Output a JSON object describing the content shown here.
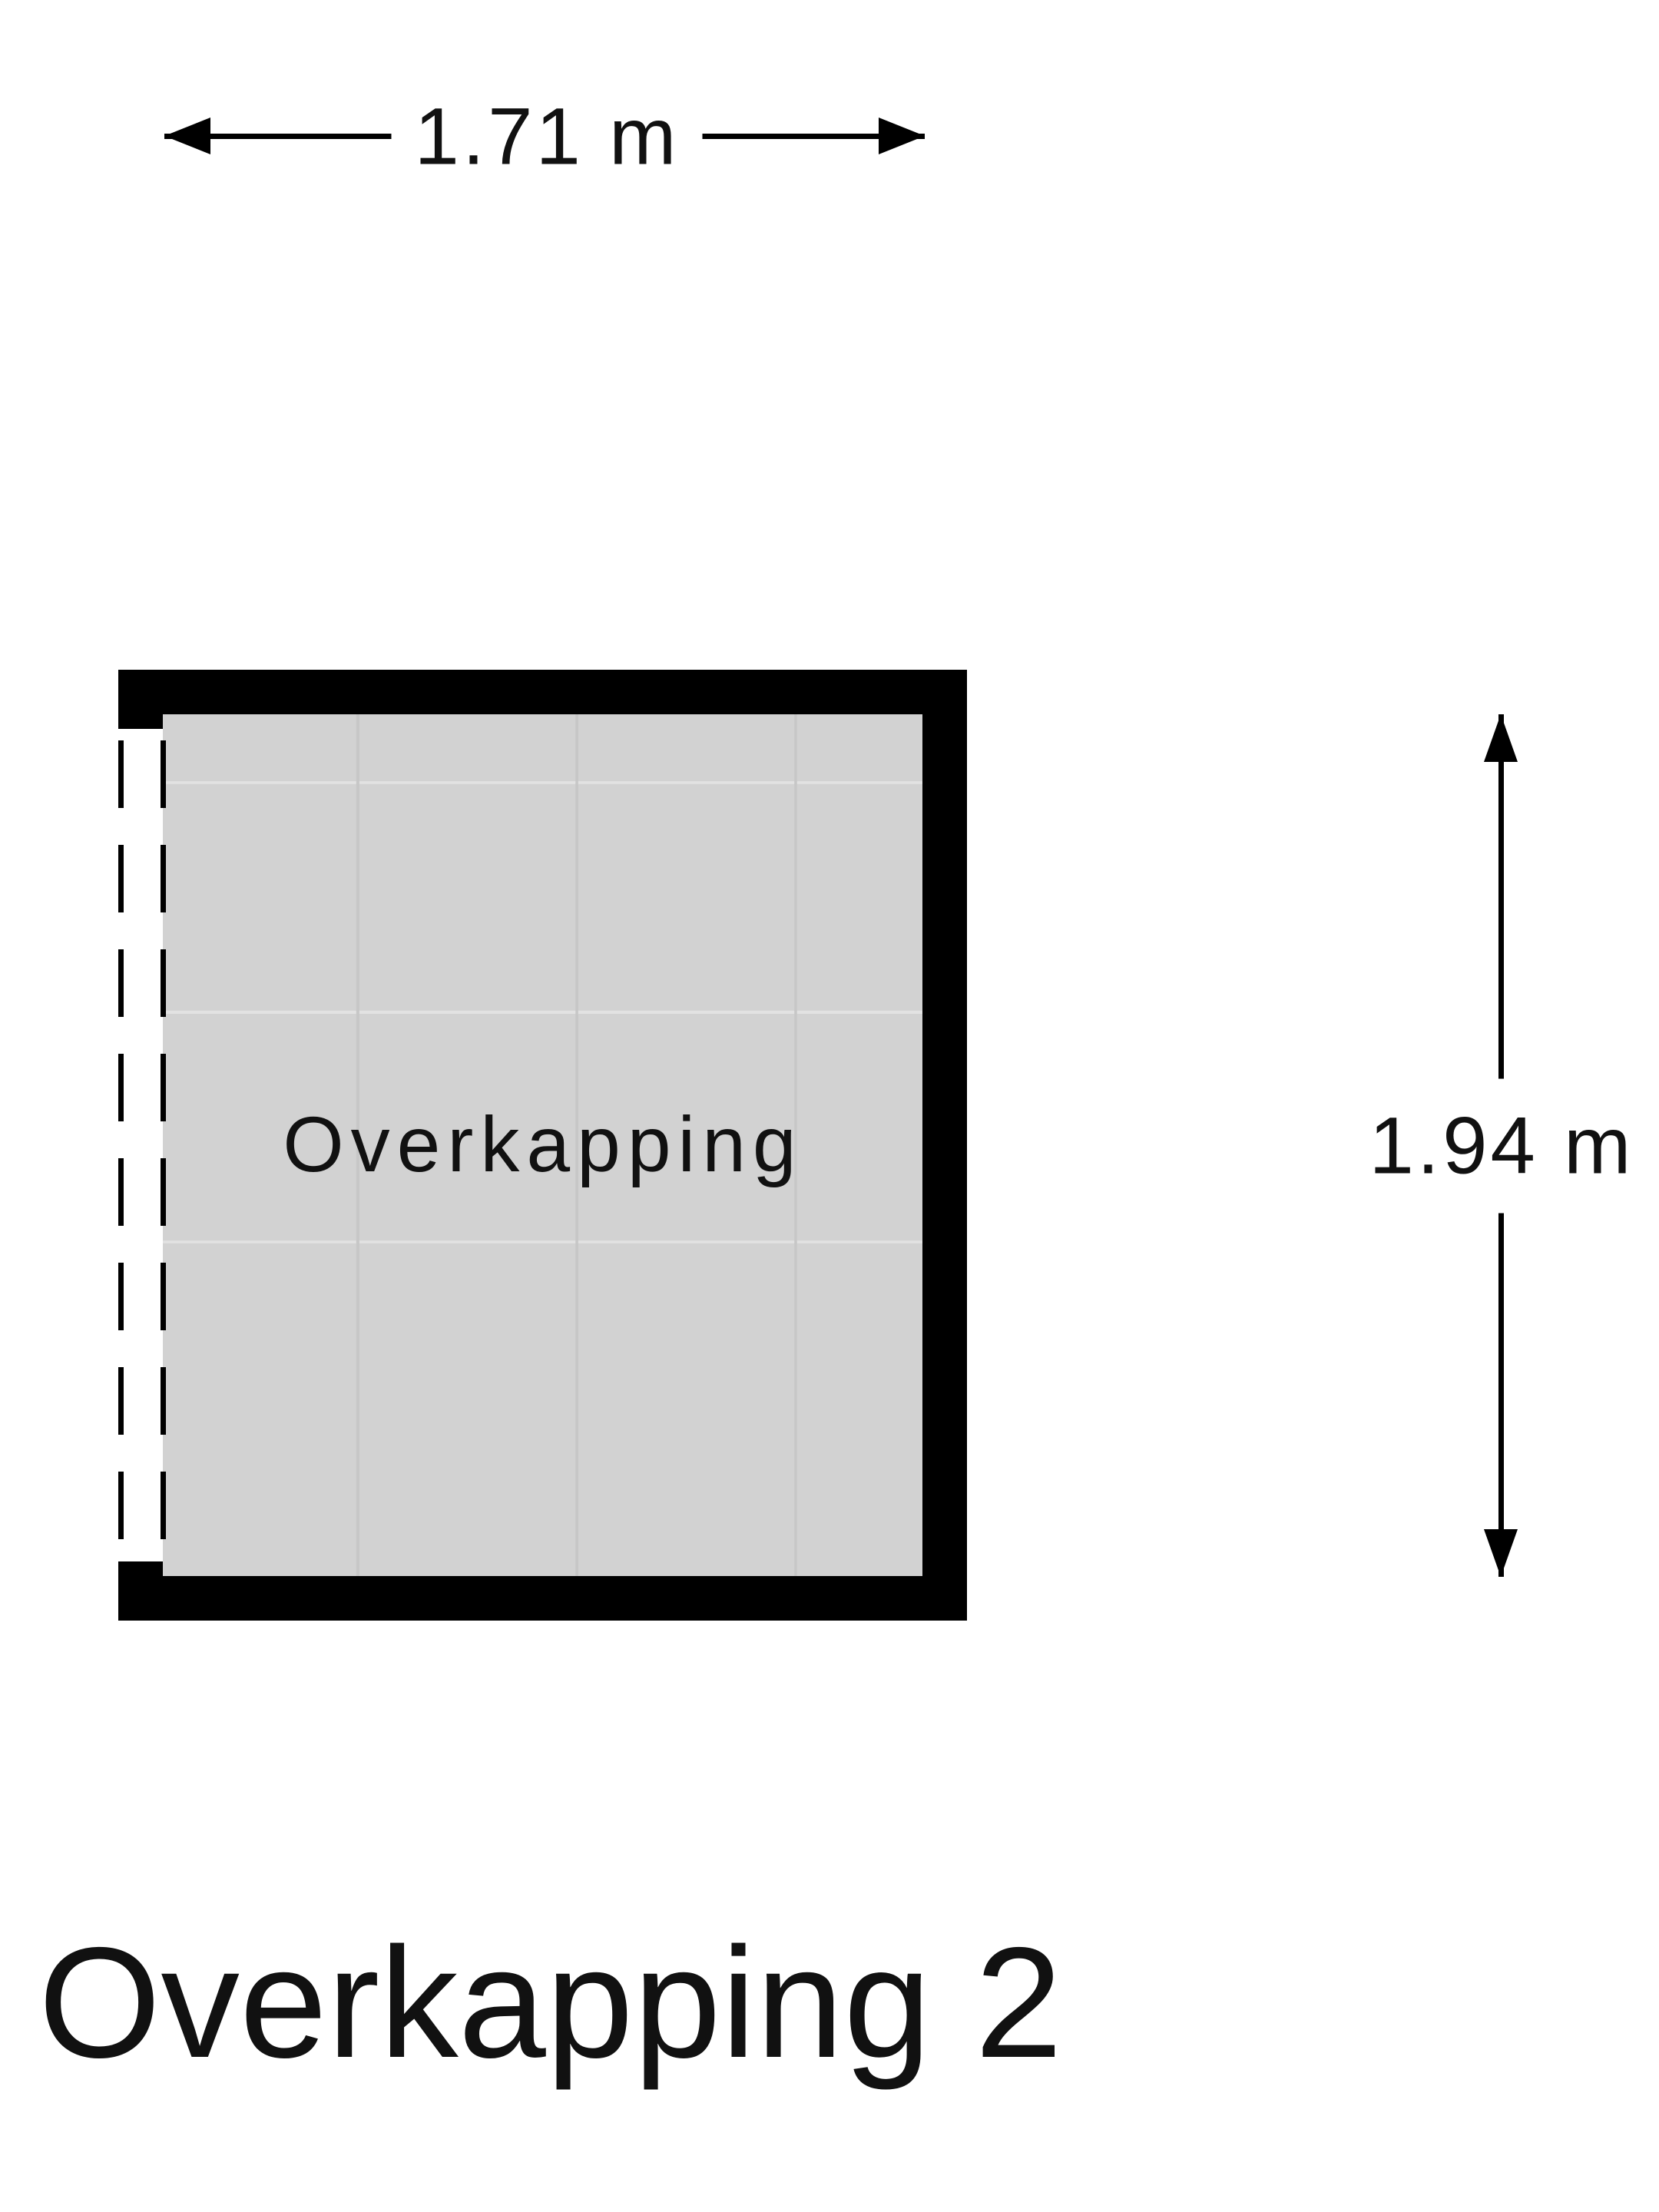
{
  "title": "Overkapping 2",
  "room_label": "Overkapping",
  "dimensions": {
    "width_label": "1.71 m",
    "height_label": "1.94 m"
  },
  "colors": {
    "background": "#ffffff",
    "wall": "#000000",
    "floor": "#d2d2d2",
    "grid_vertical": "#c7c7c7",
    "grid_horizontal": "#e2e2e2",
    "text": "#111111"
  }
}
